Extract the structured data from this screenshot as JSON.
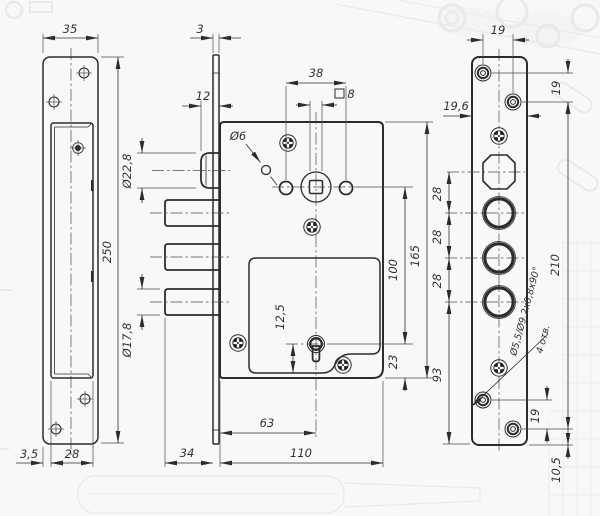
{
  "colors": {
    "line": "#2b2d2c",
    "background": "#f8f9f7",
    "ghost": "#dde1df"
  },
  "left_view": {
    "width": "35",
    "height": "250",
    "lip_offset": "3,5",
    "slot_width": "28"
  },
  "middle_view": {
    "faceplate_thickness": "3",
    "latch_protrusion": "12",
    "hole_spacing": "38",
    "spindle_square": "8",
    "pin_hole": "Ø6",
    "latch_dia": "Ø22,8",
    "deadbolt_dia": "Ø17,8",
    "keyhole_offset": "12,5",
    "keyhole_from_edge": "63",
    "deadbolt_throw": "34",
    "body_width": "110",
    "body_height": "165",
    "spindle_to_keyhole": "100",
    "keyhole_to_bottom": "23"
  },
  "right_view": {
    "hole_spacing_x": "19",
    "plate_width": "19,6",
    "hole_spacing_y": "19",
    "bolt_spacing_1": "28",
    "bolt_spacing_2": "28",
    "bolt_spacing_3": "28",
    "lower_section": "93",
    "plate_length": "210",
    "countersink_note": "Ø5,5/Ø9,2x0,8x90°",
    "holes_count": "4 отв.",
    "bottom_hole_spacing": "19",
    "bottom_hole_offset": "10,5"
  }
}
